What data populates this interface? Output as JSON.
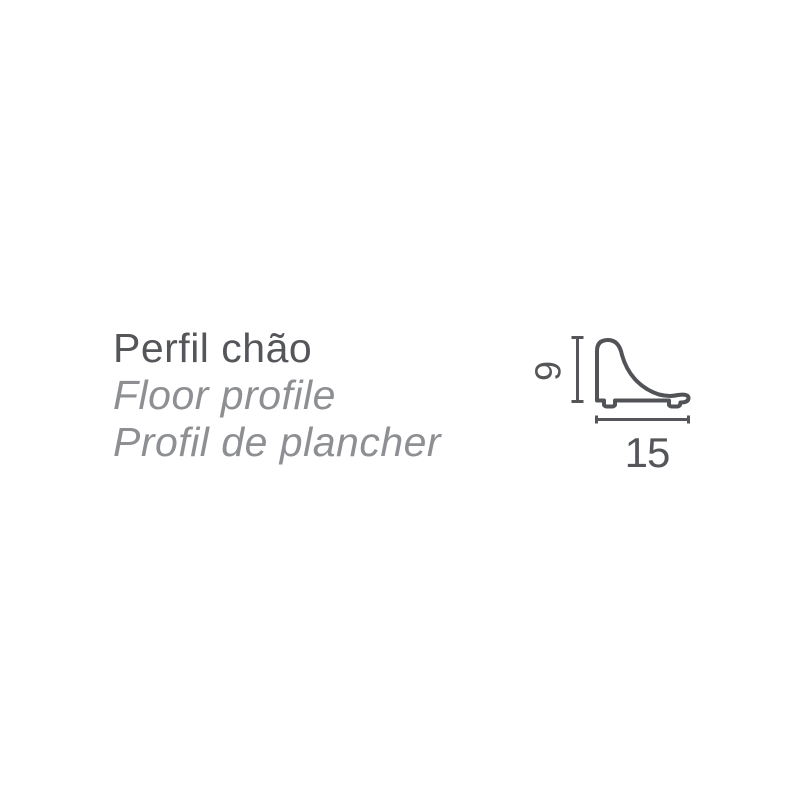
{
  "page": {
    "background_color": "#ffffff"
  },
  "product": {
    "title_pt": "Perfil chão",
    "title_en": "Floor profile",
    "title_fr": "Profil de plancher"
  },
  "diagram": {
    "description": "floor-profile-cross-section-technical-drawing",
    "height_dimension": "9",
    "width_dimension": "15",
    "outline_color": "#515356",
    "dimension_color": "#54565a"
  },
  "text_colors": {
    "title": "#54565a",
    "subtitle": "#8d8f92"
  }
}
